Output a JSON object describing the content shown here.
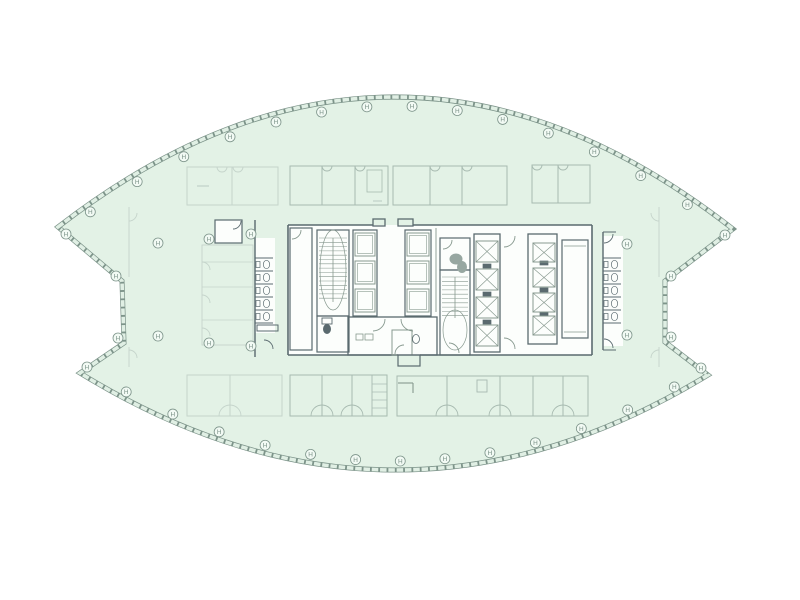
{
  "page": {
    "title": "lens-shaped tower office floor plan",
    "background": "#ffffff"
  },
  "colors": {
    "bg": "#ffffff",
    "floor": "#e3f2e6",
    "outline": "#7d948a",
    "band": "#e0efe4",
    "dark": "#5a6a6f",
    "mid": "#87998f",
    "light": "#a7bab0",
    "faint": "#c5d4cb",
    "fixture": "#97a7a1",
    "white": "#fcfefc",
    "marker_fill": "#f2faf4"
  },
  "lens": {
    "top_arc": {
      "p0": [
        58,
        227
      ],
      "c": [
        396,
        -34
      ],
      "p1": [
        733,
        229
      ]
    },
    "bottom_arc": {
      "p0": [
        708,
        375
      ],
      "c": [
        394,
        566
      ],
      "p1": [
        80,
        373
      ]
    },
    "right_notch": [
      [
        665,
        281
      ],
      [
        665,
        342
      ]
    ],
    "left_notch": [
      [
        124,
        343
      ],
      [
        122,
        281
      ]
    ]
  },
  "markers": {
    "symbol": "H",
    "radius": 5,
    "top_t": [
      0.035,
      0.105,
      0.175,
      0.245,
      0.315,
      0.385,
      0.455,
      0.525,
      0.595,
      0.665,
      0.735,
      0.805,
      0.875,
      0.945
    ],
    "bottom_t": [
      0.04,
      0.115,
      0.19,
      0.265,
      0.34,
      0.415,
      0.49,
      0.565,
      0.64,
      0.715,
      0.79,
      0.865,
      0.94
    ],
    "extra": [
      [
        66,
        234
      ],
      [
        116,
        276
      ],
      [
        118,
        338
      ],
      [
        87,
        367
      ],
      [
        725,
        235
      ],
      [
        671,
        276
      ],
      [
        671,
        337
      ],
      [
        701,
        368
      ],
      [
        158,
        243
      ],
      [
        158,
        336
      ],
      [
        209,
        239
      ],
      [
        251,
        234
      ],
      [
        209,
        343
      ],
      [
        251,
        346
      ],
      [
        627,
        244
      ],
      [
        627,
        335
      ]
    ]
  },
  "top_bands": [
    {
      "x": 187,
      "y": 167,
      "w": 91,
      "h": 38,
      "dividers": [
        232
      ],
      "notches": [
        222,
        238
      ],
      "c": "faint"
    },
    {
      "x": 290,
      "y": 166,
      "w": 98,
      "h": 39,
      "dividers": [
        322,
        355
      ],
      "notches": [
        327,
        360
      ],
      "c": "light"
    },
    {
      "x": 393,
      "y": 166,
      "w": 114,
      "h": 39,
      "dividers": [
        430,
        462
      ],
      "notches": [
        435,
        467
      ],
      "c": "light"
    },
    {
      "x": 532,
      "y": 165,
      "w": 58,
      "h": 38,
      "dividers": [
        558
      ],
      "notches": [
        537,
        563
      ],
      "c": "light"
    }
  ],
  "bottom_bands": [
    {
      "x": 187,
      "y": 375,
      "w": 95,
      "h": 41,
      "dividers": [
        230
      ],
      "pairs": [
        230
      ],
      "c": "faint"
    },
    {
      "x": 290,
      "y": 375,
      "w": 97,
      "h": 41,
      "dividers": [
        322,
        352
      ],
      "pairs": [
        322,
        352
      ],
      "c": "light"
    },
    {
      "x": 397,
      "y": 376,
      "w": 191,
      "h": 40,
      "dividers": [
        447,
        500,
        533,
        563
      ],
      "pairs": [
        447,
        500,
        563
      ],
      "c": "light"
    }
  ],
  "fills": [
    {
      "x": 288,
      "y": 225,
      "w": 304,
      "h": 130
    },
    {
      "x": 255,
      "y": 238,
      "w": 20,
      "h": 95
    },
    {
      "x": 603,
      "y": 236,
      "w": 20,
      "h": 110
    },
    {
      "x": 215,
      "y": 220,
      "w": 27,
      "h": 23
    }
  ],
  "rects": [
    {
      "x": 373,
      "y": 219,
      "w": 12,
      "h": 7,
      "c": "dark",
      "w2": 1.3
    },
    {
      "x": 398,
      "y": 219,
      "w": 15,
      "h": 7,
      "c": "dark",
      "w2": 1.3
    },
    {
      "x": 290,
      "y": 228,
      "w": 22,
      "h": 122,
      "c": "dark",
      "w2": 1.2
    },
    {
      "x": 317,
      "y": 316,
      "w": 32,
      "h": 36,
      "c": "dark",
      "w2": 1.2
    },
    {
      "x": 322,
      "y": 318,
      "w": 10,
      "h": 6,
      "c": "dark",
      "w2": 0.9
    },
    {
      "x": 348,
      "y": 317,
      "w": 89,
      "h": 38,
      "c": "dark",
      "w2": 1.3
    },
    {
      "x": 392,
      "y": 330,
      "w": 20,
      "h": 25,
      "c": "mid",
      "w2": 1.0
    },
    {
      "x": 356,
      "y": 334,
      "w": 7,
      "h": 6,
      "c": "mid",
      "w2": 0.8
    },
    {
      "x": 365,
      "y": 334,
      "w": 8,
      "h": 6,
      "c": "mid",
      "w2": 0.8
    },
    {
      "x": 398,
      "y": 355,
      "w": 22,
      "h": 11,
      "c": "dark",
      "w2": 1.2
    },
    {
      "x": 440,
      "y": 238,
      "w": 30,
      "h": 32,
      "c": "dark",
      "w2": 1.2
    },
    {
      "x": 474,
      "y": 234,
      "w": 26,
      "h": 118,
      "c": "dark",
      "w2": 1.3
    },
    {
      "x": 528,
      "y": 234,
      "w": 29,
      "h": 110,
      "c": "dark",
      "w2": 1.3
    },
    {
      "x": 562,
      "y": 240,
      "w": 26,
      "h": 98,
      "c": "dark",
      "w2": 1.2
    },
    {
      "x": 215,
      "y": 220,
      "w": 27,
      "h": 23,
      "c": "dark",
      "w2": 1.2
    },
    {
      "x": 257,
      "y": 325,
      "w": 21,
      "h": 6,
      "c": "dark",
      "w2": 1.0
    },
    {
      "x": 202,
      "y": 245,
      "w": 51,
      "h": 100,
      "c": "faint",
      "w2": 0.9
    },
    {
      "x": 372,
      "y": 375,
      "w": 15,
      "h": 41,
      "c": "light",
      "w2": 0.9
    },
    {
      "x": 477,
      "y": 380,
      "w": 10,
      "h": 12,
      "c": "light",
      "w2": 0.9
    },
    {
      "x": 367,
      "y": 170,
      "w": 15,
      "h": 22,
      "c": "light",
      "w2": 0.8
    },
    {
      "x": 483,
      "y": 264,
      "w": 8,
      "h": 4,
      "c": "dark",
      "w2": 0.7,
      "f": "dark"
    },
    {
      "x": 483,
      "y": 292,
      "w": 8,
      "h": 4,
      "c": "dark",
      "w2": 0.7,
      "f": "dark"
    },
    {
      "x": 483,
      "y": 320,
      "w": 8,
      "h": 4,
      "c": "dark",
      "w2": 0.7,
      "f": "dark"
    },
    {
      "x": 540,
      "y": 261,
      "w": 8,
      "h": 4,
      "c": "dark",
      "w2": 0.7,
      "f": "dark"
    },
    {
      "x": 540,
      "y": 288,
      "w": 8,
      "h": 4,
      "c": "dark",
      "w2": 0.7,
      "f": "dark"
    },
    {
      "x": 540,
      "y": 312,
      "w": 8,
      "h": 4,
      "c": "dark",
      "w2": 0.7,
      "f": "dark"
    }
  ],
  "lines": [
    {
      "x1": 288,
      "y1": 225,
      "x2": 373,
      "y2": 225,
      "c": "dark",
      "w": 1.6
    },
    {
      "x1": 413,
      "y1": 225,
      "x2": 592,
      "y2": 225,
      "c": "dark",
      "w": 1.6
    },
    {
      "x1": 288,
      "y1": 355,
      "x2": 398,
      "y2": 355,
      "c": "dark",
      "w": 1.6
    },
    {
      "x1": 420,
      "y1": 355,
      "x2": 592,
      "y2": 355,
      "c": "dark",
      "w": 1.6
    },
    {
      "x1": 288,
      "y1": 225,
      "x2": 288,
      "y2": 355,
      "c": "dark",
      "w": 1.6
    },
    {
      "x1": 592,
      "y1": 225,
      "x2": 592,
      "y2": 355,
      "c": "dark",
      "w": 1.6
    },
    {
      "x1": 436,
      "y1": 228,
      "x2": 436,
      "y2": 312,
      "c": "mid",
      "w": 0.9
    },
    {
      "x1": 564,
      "y1": 246,
      "x2": 586,
      "y2": 246,
      "c": "mid",
      "w": 0.8
    },
    {
      "x1": 564,
      "y1": 332,
      "x2": 586,
      "y2": 332,
      "c": "mid",
      "w": 0.8
    },
    {
      "x1": 398,
      "y1": 383,
      "x2": 413,
      "y2": 383,
      "c": "mid",
      "w": 1.1
    },
    {
      "x1": 413,
      "y1": 383,
      "x2": 413,
      "y2": 393,
      "c": "mid",
      "w": 1.1
    },
    {
      "x1": 372,
      "y1": 384,
      "x2": 387,
      "y2": 384,
      "c": "light",
      "w": 0.7
    },
    {
      "x1": 372,
      "y1": 392,
      "x2": 387,
      "y2": 392,
      "c": "light",
      "w": 0.7
    },
    {
      "x1": 372,
      "y1": 400,
      "x2": 387,
      "y2": 400,
      "c": "light",
      "w": 0.7
    },
    {
      "x1": 372,
      "y1": 408,
      "x2": 387,
      "y2": 408,
      "c": "light",
      "w": 0.7
    },
    {
      "x1": 202,
      "y1": 262,
      "x2": 253,
      "y2": 262,
      "c": "faint",
      "w": 0.8
    },
    {
      "x1": 202,
      "y1": 287,
      "x2": 253,
      "y2": 287,
      "c": "faint",
      "w": 0.8
    },
    {
      "x1": 202,
      "y1": 320,
      "x2": 253,
      "y2": 320,
      "c": "faint",
      "w": 0.8
    },
    {
      "x1": 129,
      "y1": 207,
      "x2": 129,
      "y2": 277,
      "c": "faint",
      "w": 0.9
    },
    {
      "x1": 129,
      "y1": 347,
      "x2": 129,
      "y2": 367,
      "c": "faint",
      "w": 0.9
    },
    {
      "x1": 659,
      "y1": 207,
      "x2": 659,
      "y2": 277,
      "c": "faint",
      "w": 0.9
    },
    {
      "x1": 659,
      "y1": 347,
      "x2": 659,
      "y2": 367,
      "c": "faint",
      "w": 0.9
    },
    {
      "x1": 197,
      "y1": 186,
      "x2": 209,
      "y2": 186,
      "c": "light",
      "w": 0.7
    },
    {
      "x1": 373,
      "y1": 201,
      "x2": 382,
      "y2": 201,
      "c": "light",
      "w": 0.7
    },
    {
      "x1": 603,
      "y1": 232,
      "x2": 616,
      "y2": 232,
      "c": "dark",
      "w": 1.0
    },
    {
      "x1": 603,
      "y1": 350,
      "x2": 616,
      "y2": 350,
      "c": "dark",
      "w": 1.0
    }
  ],
  "stairs": [
    {
      "x": 317,
      "y": 230,
      "w": 32,
      "h": 86,
      "t1": 238,
      "t2": 302,
      "ex": 333,
      "ey": 270,
      "rx": 13,
      "ry": 40
    },
    {
      "x": 440,
      "y": 270,
      "w": 30,
      "h": 85,
      "t1": 277,
      "t2": 318,
      "ex": 455,
      "ey": 330,
      "rx": 12,
      "ry": 20
    }
  ],
  "shaft_stacks": [
    {
      "x": 353,
      "y": 230,
      "w": 24,
      "cells": [
        233,
        261,
        289
      ],
      "ch": 23
    },
    {
      "x": 405,
      "y": 230,
      "w": 26,
      "cells": [
        233,
        261,
        289
      ],
      "ch": 23
    }
  ],
  "elevator_cars": [
    {
      "x": 476,
      "w": 22,
      "h": 21,
      "ys": [
        241,
        269,
        297,
        325
      ]
    },
    {
      "x": 533,
      "w": 22,
      "h": 19,
      "ys": [
        243,
        268,
        293,
        316
      ]
    }
  ],
  "toilet_rows": [
    {
      "wx": 255,
      "y1": 220,
      "y2": 357,
      "stubs": [
        258,
        271,
        284,
        297,
        310,
        323
      ],
      "len": 18
    },
    {
      "wx": 603,
      "y1": 232,
      "y2": 350,
      "stubs": [
        258,
        271,
        284,
        297,
        310,
        323
      ],
      "len": 18
    }
  ],
  "fixtures": [
    {
      "cx": 327,
      "cy": 329,
      "rx": 4,
      "ry": 5,
      "f": "dark"
    },
    {
      "cx": 456,
      "cy": 259,
      "rx": 6.5,
      "ry": 5.5,
      "f": "fixture"
    },
    {
      "cx": 462,
      "cy": 267,
      "rx": 5,
      "ry": 6,
      "f": "fixture"
    },
    {
      "cx": 416,
      "cy": 339,
      "rx": 3.5,
      "ry": 4.5,
      "f": "none"
    }
  ],
  "door_arcs": [
    {
      "x": 373,
      "y": 319,
      "r": 12,
      "sx": 1,
      "sy": 1,
      "c": "mid"
    },
    {
      "x": 413,
      "y": 319,
      "r": 12,
      "sx": -1,
      "sy": 1,
      "c": "mid"
    },
    {
      "x": 404,
      "y": 354,
      "r": 9,
      "sx": -1,
      "sy": -1,
      "c": "mid"
    },
    {
      "x": 443,
      "y": 240,
      "r": 9,
      "sx": 1,
      "sy": 1,
      "c": "mid"
    },
    {
      "x": 449,
      "y": 353,
      "r": 10,
      "sx": 1,
      "sy": -1,
      "c": "mid"
    },
    {
      "x": 504,
      "y": 236,
      "r": 11,
      "sx": 1,
      "sy": 1,
      "c": "mid"
    },
    {
      "x": 504,
      "y": 349,
      "r": 11,
      "sx": 1,
      "sy": -1,
      "c": "mid"
    },
    {
      "x": 604,
      "y": 234,
      "r": 9,
      "sx": 1,
      "sy": 1,
      "c": "dark"
    },
    {
      "x": 604,
      "y": 348,
      "r": 9,
      "sx": 1,
      "sy": -1,
      "c": "dark"
    },
    {
      "x": 233,
      "y": 221,
      "r": 8,
      "sx": 1,
      "sy": 1,
      "c": "dark"
    },
    {
      "x": 264,
      "y": 349,
      "r": 9,
      "sx": 1,
      "sy": -1,
      "c": "dark"
    },
    {
      "x": 202,
      "y": 270,
      "r": 8,
      "sx": 1,
      "sy": -1,
      "c": "faint"
    },
    {
      "x": 202,
      "y": 303,
      "r": 8,
      "sx": 1,
      "sy": -1,
      "c": "faint"
    },
    {
      "x": 202,
      "y": 336,
      "r": 8,
      "sx": 1,
      "sy": -1,
      "c": "faint"
    },
    {
      "x": 129,
      "y": 213,
      "r": 8,
      "sx": 1,
      "sy": 1,
      "c": "faint"
    },
    {
      "x": 129,
      "y": 358,
      "r": 8,
      "sx": 1,
      "sy": -1,
      "c": "faint"
    },
    {
      "x": 659,
      "y": 213,
      "r": 8,
      "sx": -1,
      "sy": 1,
      "c": "faint"
    },
    {
      "x": 659,
      "y": 358,
      "r": 8,
      "sx": -1,
      "sy": -1,
      "c": "faint"
    },
    {
      "x": 292,
      "y": 230,
      "r": 9,
      "sx": 1,
      "sy": 1,
      "c": "mid"
    }
  ]
}
